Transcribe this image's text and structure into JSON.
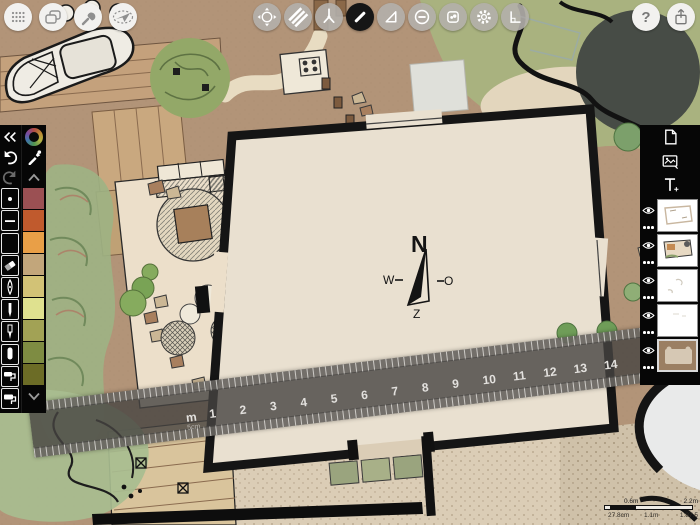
{
  "window_bar": {
    "icons": [
      "dots-grid-icon",
      "overlapping-windows-icon",
      "wrench-icon",
      "projector-crossed-icon"
    ]
  },
  "toolbar": {
    "help_label": "?",
    "tools": [
      {
        "id": "transform",
        "icon": "move-arrows-icon",
        "active": false
      },
      {
        "id": "fill",
        "icon": "hatch-stripes-icon",
        "active": false
      },
      {
        "id": "airbrush",
        "icon": "nib-icon",
        "active": false
      },
      {
        "id": "pen",
        "icon": "pen-stroke-icon",
        "active": true
      },
      {
        "id": "shape-guide",
        "icon": "triangle-icon",
        "active": false
      },
      {
        "id": "eraser-mode",
        "icon": "minus-circle-icon",
        "active": false
      },
      {
        "id": "item-picker",
        "icon": "rounded-square-icon",
        "active": false
      },
      {
        "id": "settings",
        "icon": "gear-icon",
        "active": false
      },
      {
        "id": "precision",
        "icon": "corner-angle-icon",
        "active": false
      }
    ],
    "share_icon": "share-icon"
  },
  "left_panel": {
    "collapse_icon": "double-chevron-left-icon",
    "undo_icon": "undo-arrow-icon",
    "redo_icon": "redo-arrow-icon",
    "color_wheel_icon": "color-wheel-icon",
    "eyedropper_icon": "eyedropper-icon",
    "tools": [
      "point",
      "line",
      "empty",
      "eraser",
      "fountain-pen",
      "fineliner",
      "technical-pen",
      "marker",
      "paint-roller",
      "paint-roller-2"
    ],
    "swatches": [
      "#9b5053",
      "#c05a2d",
      "#e99f47",
      "#c2a67b",
      "#d2c276",
      "#dfe18f",
      "#a2a255",
      "#7e8c42",
      "#6c6c26"
    ]
  },
  "right_panel": {
    "buttons": [
      "new-page",
      "import-image",
      "add-text"
    ],
    "layers": [
      {
        "name": "layer-1",
        "thumb": "sketch-outline",
        "visible": true,
        "selected": false
      },
      {
        "name": "layer-2",
        "thumb": "colored-plan",
        "visible": true,
        "selected": false
      },
      {
        "name": "layer-3",
        "thumb": "faint-marks",
        "visible": true,
        "selected": false
      },
      {
        "name": "layer-4",
        "thumb": "nearly-blank",
        "visible": true,
        "selected": false
      },
      {
        "name": "layer-5",
        "thumb": "ground-brown",
        "visible": true,
        "selected": true
      }
    ]
  },
  "ruler": {
    "unit_label": "m",
    "subunit_label": "5cm",
    "numbers": [
      "1",
      "2",
      "3",
      "4",
      "5",
      "6",
      "7",
      "8",
      "9",
      "10",
      "11",
      "12",
      "13",
      "14"
    ]
  },
  "compass": {
    "north": "N",
    "east": "O",
    "south": "Z",
    "west": "W"
  },
  "scale_bar": {
    "top_mid": "0.6m",
    "top_right": "2.2m",
    "bottom_left": "27.8cm",
    "bottom_mid": "1.1m",
    "bottom_right": "1:87.5"
  },
  "colors": {
    "paper": "#b29478",
    "panel": "#060606",
    "active_tool": "#161616",
    "ruler": "rgba(70,68,65,0.8)"
  }
}
